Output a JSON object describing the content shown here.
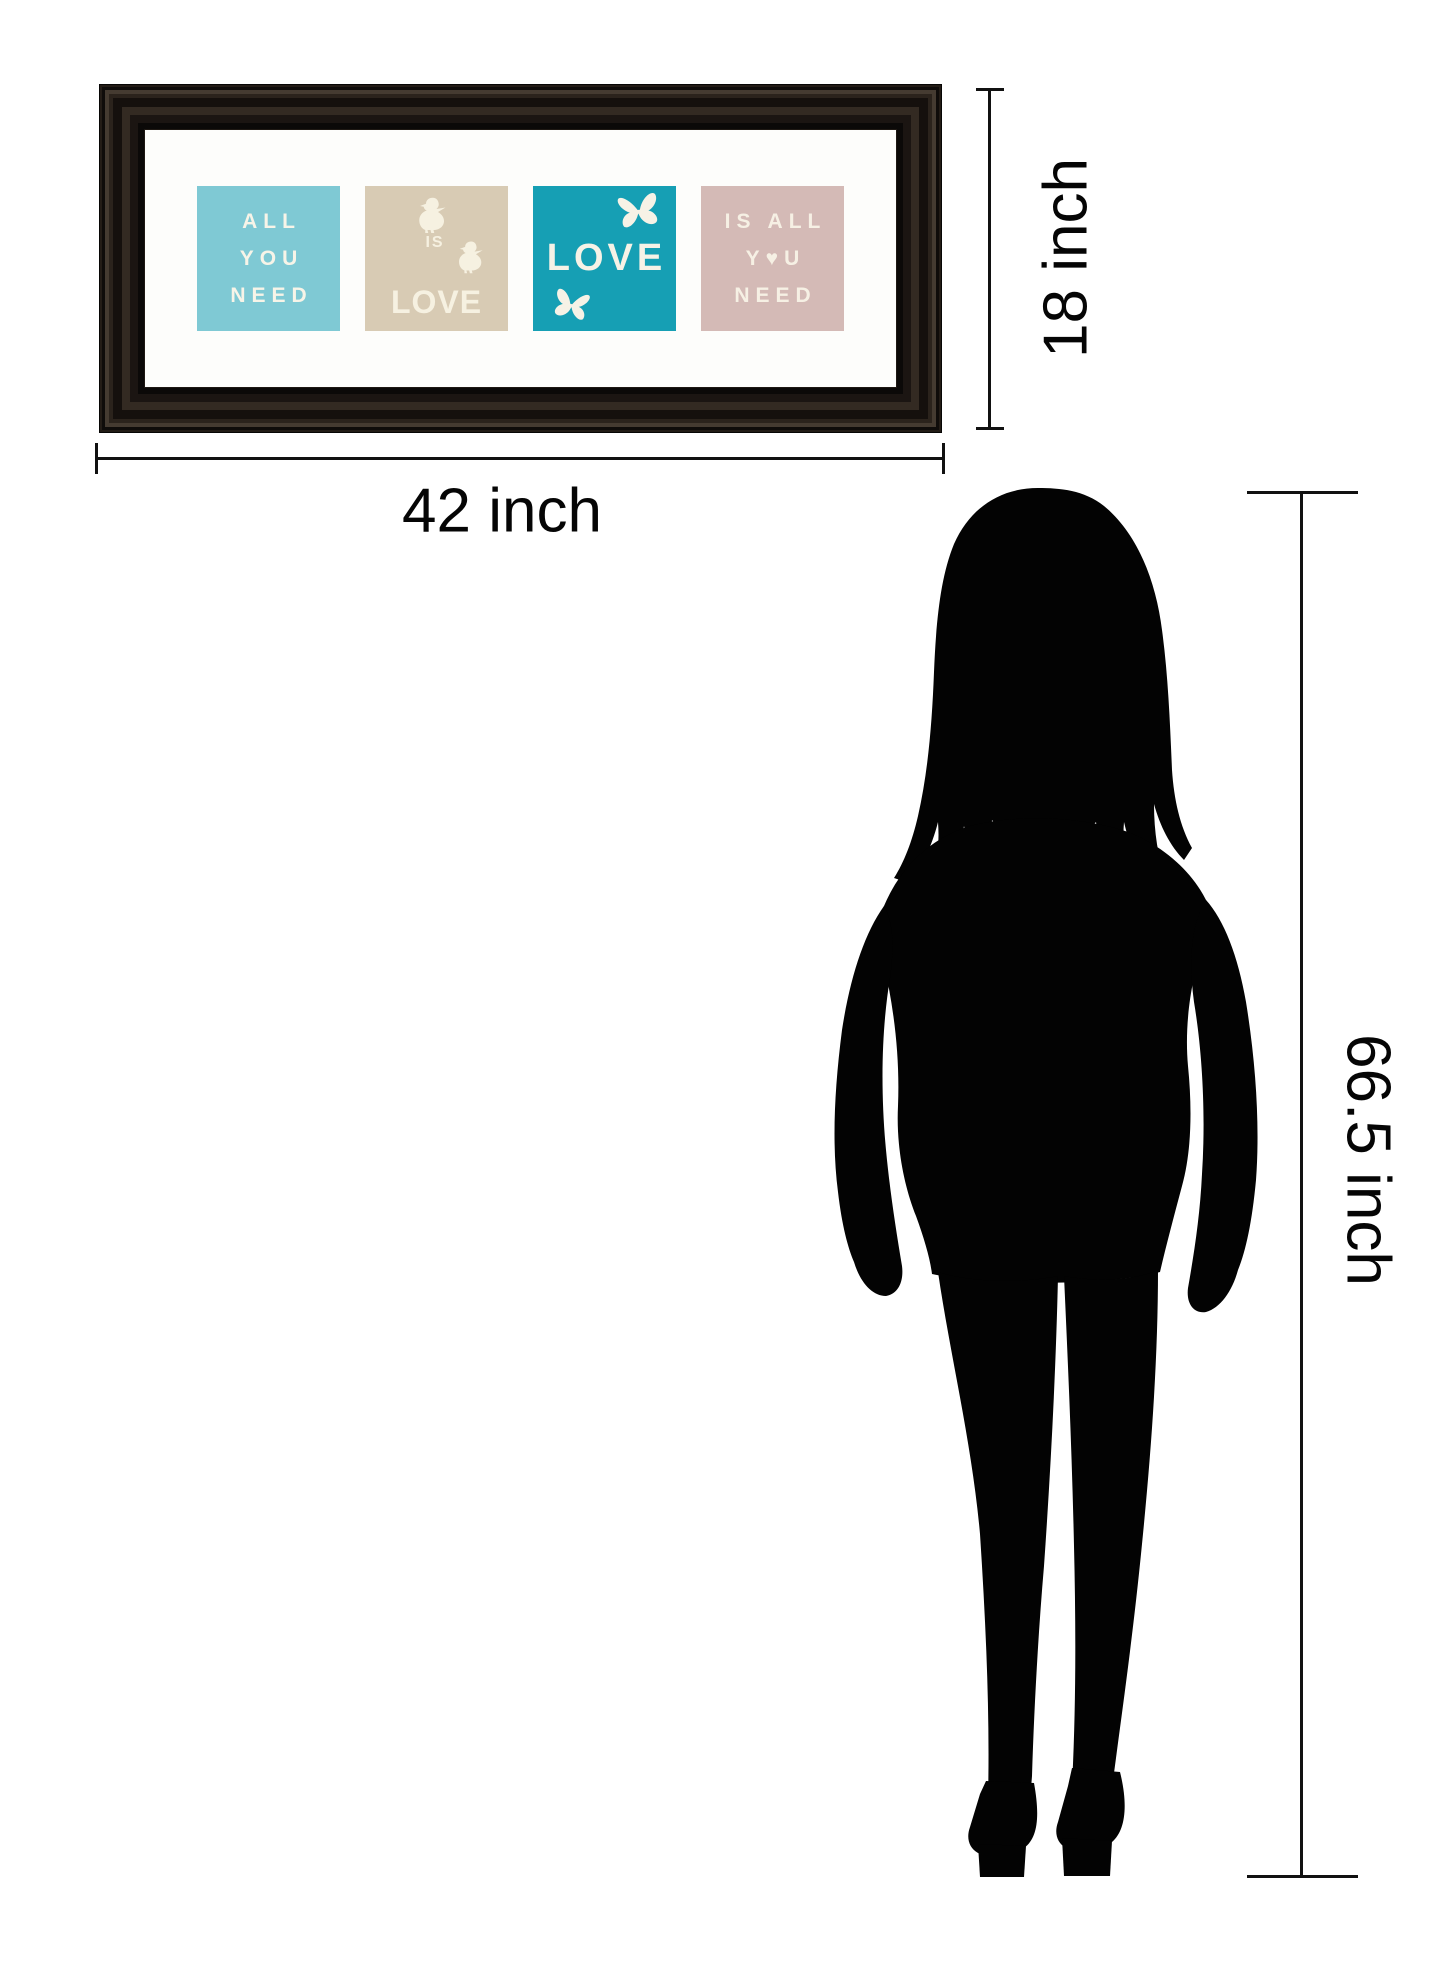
{
  "page": {
    "background": "#ffffff",
    "description": "Framed wall art size comparison diagram"
  },
  "artwork_frame": {
    "frame_color": "#1e1813",
    "mat_color": "#fdfdfb",
    "panels": [
      {
        "bg": "#7fc9d4",
        "text_color": "#f7f4e8",
        "lines": [
          "ALL",
          "YOU",
          "NEED"
        ]
      },
      {
        "bg": "#d8cbb4",
        "text_color": "#f6f1e1",
        "word_small": "IS",
        "word_large": "LOVE",
        "icons": [
          "bird-icon",
          "bird-icon"
        ]
      },
      {
        "bg": "#169fb4",
        "text_color": "#f6f2e6",
        "word": "LOVE",
        "icons": [
          "butterfly-icon",
          "butterfly-icon"
        ]
      },
      {
        "bg": "#d4bab6",
        "text_color": "#f6f0e4",
        "lines": [
          "IS ALL",
          "Y♥U",
          "NEED"
        ]
      }
    ]
  },
  "dimensions": {
    "width_label": "42 inch",
    "height_label": "18 inch",
    "figure_height_label": "66.5 inch",
    "line_color": "#111111"
  },
  "figure": {
    "name": "female-silhouette",
    "color": "#030303"
  }
}
